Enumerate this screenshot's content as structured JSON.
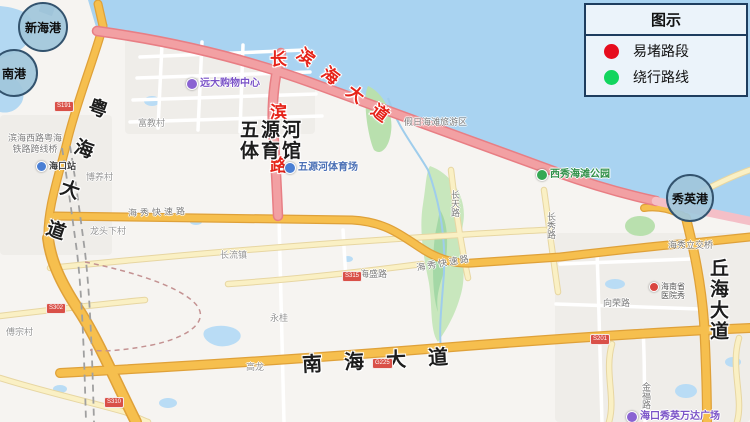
{
  "legend": {
    "title": "图示",
    "congested_label": "易堵路段",
    "congested_color": "#e60c1d",
    "detour_label": "绕行路线",
    "detour_color": "#12d55e"
  },
  "ports": {
    "xinhai": "新海港",
    "nangang": "南港",
    "xiuying": "秀英港"
  },
  "congested_roads": {
    "binhai_dadao": "滨海大道",
    "changbin_lu": "长滨路"
  },
  "major_roads": {
    "yuehai_dadao": "粤海大道",
    "nanhai_dadao": "南海大道",
    "qiuhai_dadao": "丘海大道"
  },
  "road_labels": {
    "haixiu_expressway_west": "海秀快速路",
    "haixiu_expressway_east": "海秀快速路",
    "haisheng_lu": "海盛路",
    "xiangrong_lu": "向荣路",
    "haixiu_interchange": "海秀立交桥",
    "changtian_lu": "长天路",
    "changxiu_lu": "长秀路",
    "jinfu_lu": "金福路",
    "overpass_line1": "滨海西路粤海",
    "overpass_line2": "铁路跨线桥"
  },
  "area_labels": {
    "holiday_beach": "假日海滩旅游区",
    "changliu_town": "长流镇",
    "longtouxia_village": "龙头下村",
    "boyang_village": "博养村",
    "fujiao_village": "富教村",
    "fuzong_village": "傅宗村",
    "yonggui": "永桂",
    "gaolong": "高龙"
  },
  "pois": {
    "yuanda_mall": "远大购物中心",
    "haikou_station": "海口站",
    "stadium_title_line1": "五源河",
    "stadium_title_line2": "体育馆",
    "stadium_poi": "五源河体育场",
    "xixiu_beach_park": "西秀海滩公园",
    "hospital_line1": "海南省",
    "hospital_line2": "医院秀",
    "wanda_plaza": "海口秀英万达广场"
  },
  "shields": {
    "s1": "S191",
    "s2": "S315",
    "s3": "G225",
    "s4": "S302",
    "s5": "S310",
    "s6": "S201"
  }
}
